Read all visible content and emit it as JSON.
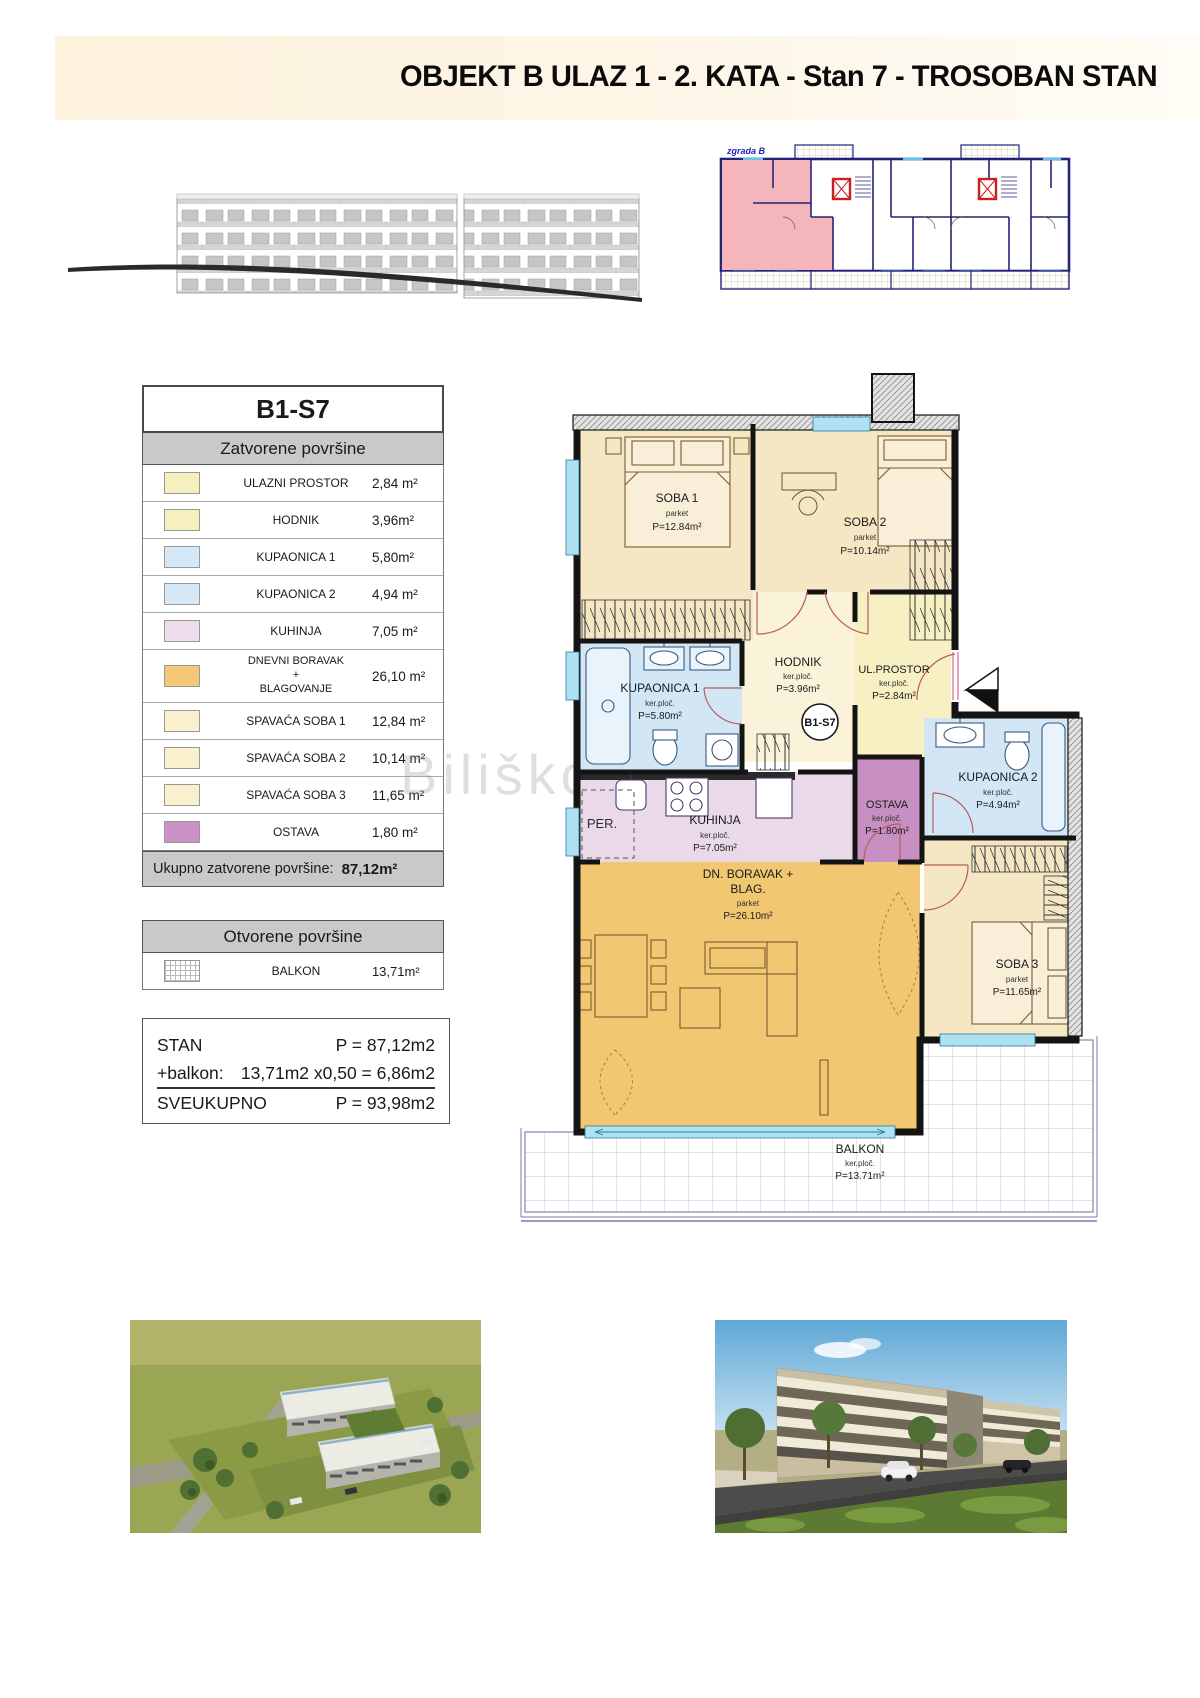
{
  "header": {
    "title": "OBJEKT B ULAZ 1 - 2. KATA -  Stan 7 - TROSOBAN STAN"
  },
  "overview": {
    "building_label": "zgrada B"
  },
  "colors": {
    "bedroom_cream": "#f6e7c4",
    "bathroom_blue": "#d2e6f5",
    "kitchen_pink": "#ead9e8",
    "living_orange": "#f2c772",
    "storage_purple": "#c78fc2",
    "entry_yellow": "#f7f0c2",
    "hall_cream": "#fbf2da",
    "highlight_unit_pink": "#f4b6ba",
    "window_cyan": "#aee2f2",
    "wall_black": "#141414",
    "table_header_gray": "#c9c9c9"
  },
  "unit_table": {
    "title": "B1-S7",
    "closed_header": "Zatvorene površine",
    "rows": [
      {
        "name": "ULAZNI PROSTOR",
        "area": "2,84 m²",
        "color": "#f6f0bf"
      },
      {
        "name": "HODNIK",
        "area": "3,96m²",
        "color": "#f6f0bf"
      },
      {
        "name": "KUPAONICA 1",
        "area": "5,80m²",
        "color": "#d4e8f7"
      },
      {
        "name": "KUPAONICA 2",
        "area": "4,94 m²",
        "color": "#d4e8f7"
      },
      {
        "name": "KUHINJA",
        "area": "7,05 m²",
        "color": "#eedcec"
      },
      {
        "name": "DNEVNI BORAVAK\n+\nBLAGOVANJE",
        "area": "26,10 m²",
        "color": "#f5c878"
      },
      {
        "name": "SPAVAĆA SOBA 1",
        "area": "12,84 m²",
        "color": "#fbf0cd"
      },
      {
        "name": "SPAVAĆA SOBA 2",
        "area": "10,14 m²",
        "color": "#fbf0cd"
      },
      {
        "name": "SPAVAĆA SOBA 3",
        "area": "11,65 m²",
        "color": "#fbf0cd"
      },
      {
        "name": "OSTAVA",
        "area": "1,80 m²",
        "color": "#cc92c6"
      }
    ],
    "total_label": "Ukupno zatvorene površine:",
    "total_value": "87,12m²",
    "open_header": "Otvorene površine",
    "open_row": {
      "name": "BALKON",
      "area": "13,71m²"
    }
  },
  "summary": {
    "line1_label": "STAN",
    "line1_value": "P = 87,12m2",
    "line2_label": "+balkon:",
    "line2_value": "13,71m2 x0,50 =  6,86m2",
    "line3_label": "SVEUKUPNO",
    "line3_value": "P = 93,98m2"
  },
  "floorplan": {
    "unit_badge": "B1-S7",
    "washer_label": "PER.",
    "rooms": {
      "soba1": {
        "name": "SOBA 1",
        "floor": "parket",
        "area": "P=12.84m²"
      },
      "soba2": {
        "name": "SOBA 2",
        "floor": "parket",
        "area": "P=10.14m²"
      },
      "soba3": {
        "name": "SOBA 3",
        "floor": "parket",
        "area": "P=11.65m²"
      },
      "kupaonica1": {
        "name": "KUPAONICA 1",
        "floor": "ker.ploč.",
        "area": "P=5.80m²"
      },
      "kupaonica2": {
        "name": "KUPAONICA 2",
        "floor": "ker.ploč.",
        "area": "P=4.94m²"
      },
      "hodnik": {
        "name": "HODNIK",
        "floor": "ker.ploč.",
        "area": "P=3.96m²"
      },
      "ulprostor": {
        "name": "UL.PROSTOR",
        "floor": "ker.ploč.",
        "area": "P=2.84m²"
      },
      "ostava": {
        "name": "OSTAVA",
        "floor": "ker.ploč.",
        "area": "P=1.80m²"
      },
      "kuhinja": {
        "name": "KUHINJA",
        "floor": "ker.ploč.",
        "area": "P=7.05m²"
      },
      "boravak": {
        "name": "DN. BORAVAK +",
        "name2": "BLAG.",
        "floor": "parket",
        "area": "P=26.10m²"
      },
      "balkon": {
        "name": "BALKON",
        "floor": "ker.ploč.",
        "area": "P=13.71m²"
      }
    }
  },
  "watermark": "Biliškov"
}
